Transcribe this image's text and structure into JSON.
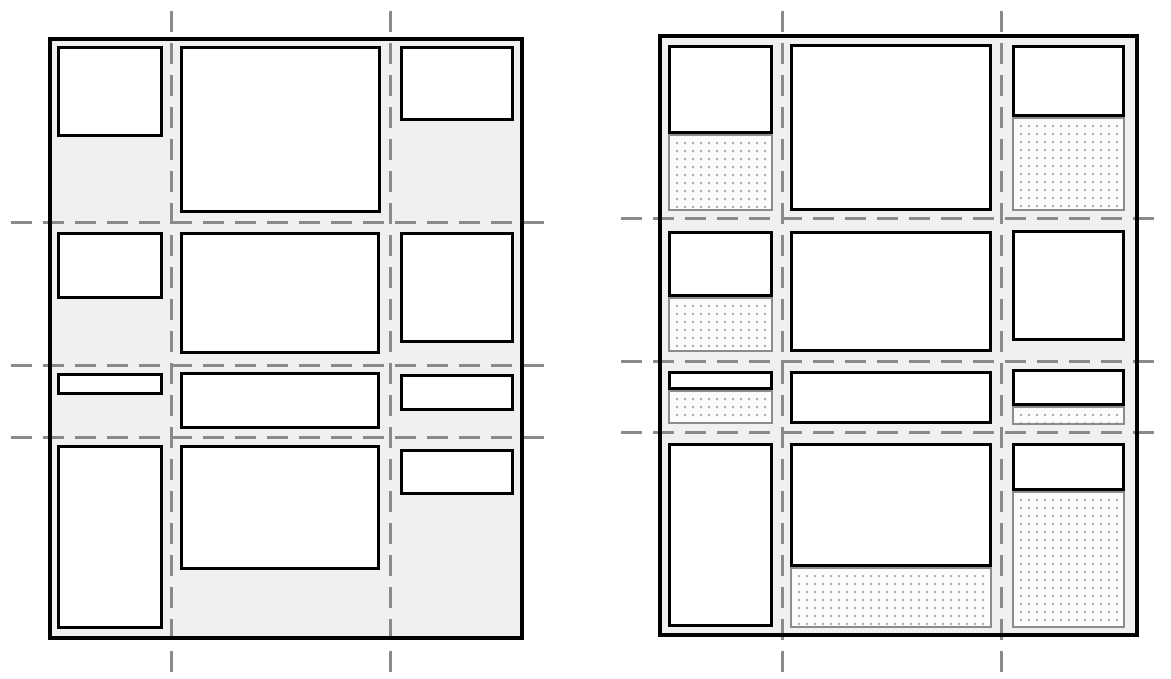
{
  "canvas": {
    "width": 1171,
    "height": 679,
    "background": "#ffffff"
  },
  "style": {
    "container_background": "#f0f0f0",
    "container_border_color": "#000000",
    "container_border_width": 4,
    "item_background": "#ffffff",
    "item_border_color": "#000000",
    "item_border_width": 3,
    "filler_background": "#fcfcfc",
    "filler_border_color": "#8c8c8c",
    "filler_border_width": 2,
    "filler_dot_color": "#b0b0b0",
    "filler_dot_spacing": 8,
    "gridline_color": "#8a8a8a",
    "gridline_thickness": 3,
    "gridline_dash": 21,
    "gridline_gap": 11
  },
  "panels": [
    {
      "id": "left-grid-diagram",
      "container": {
        "x": 48,
        "y": 37,
        "w": 476,
        "h": 603
      },
      "gridlines": {
        "vertical": [
          {
            "x": 170,
            "y1": 11,
            "y2": 672
          },
          {
            "x": 389,
            "y1": 11,
            "y2": 672
          }
        ],
        "horizontal": [
          {
            "y": 221,
            "x1": 11,
            "x2": 547
          },
          {
            "y": 364,
            "x1": 11,
            "x2": 547
          },
          {
            "y": 436,
            "x1": 11,
            "x2": 547
          }
        ]
      },
      "items": [
        [
          57,
          46,
          106,
          91
        ],
        [
          180,
          46,
          201,
          167
        ],
        [
          400,
          46,
          114,
          75
        ],
        [
          57,
          232,
          106,
          67
        ],
        [
          180,
          232,
          200,
          122
        ],
        [
          400,
          232,
          114,
          111
        ],
        [
          57,
          373,
          106,
          22
        ],
        [
          180,
          372,
          200,
          57
        ],
        [
          400,
          374,
          114,
          37
        ],
        [
          57,
          445,
          106,
          184
        ],
        [
          180,
          445,
          200,
          125
        ],
        [
          400,
          449,
          114,
          46
        ]
      ],
      "fillers": []
    },
    {
      "id": "right-grid-diagram",
      "container": {
        "x": 658,
        "y": 34,
        "w": 481,
        "h": 603
      },
      "gridlines": {
        "vertical": [
          {
            "x": 781,
            "y1": 11,
            "y2": 672
          },
          {
            "x": 1000,
            "y1": 11,
            "y2": 672
          }
        ],
        "horizontal": [
          {
            "y": 217,
            "x1": 621,
            "x2": 1157
          },
          {
            "y": 360,
            "x1": 621,
            "x2": 1157
          },
          {
            "y": 431,
            "x1": 621,
            "x2": 1157
          }
        ]
      },
      "items": [
        [
          668,
          45,
          105,
          89
        ],
        [
          790,
          44,
          202,
          167
        ],
        [
          1012,
          45,
          113,
          72
        ],
        [
          668,
          231,
          105,
          66
        ],
        [
          790,
          231,
          202,
          121
        ],
        [
          1012,
          230,
          113,
          111
        ],
        [
          668,
          371,
          105,
          19
        ],
        [
          790,
          371,
          202,
          53
        ],
        [
          1012,
          369,
          113,
          37
        ],
        [
          668,
          443,
          105,
          184
        ],
        [
          790,
          443,
          202,
          124
        ],
        [
          1012,
          443,
          113,
          48
        ]
      ],
      "fillers": [
        [
          668,
          134,
          105,
          77
        ],
        [
          1012,
          117,
          113,
          94
        ],
        [
          668,
          297,
          105,
          55
        ],
        [
          668,
          390,
          105,
          34
        ],
        [
          1012,
          406,
          113,
          19
        ],
        [
          790,
          567,
          202,
          61
        ],
        [
          1012,
          491,
          113,
          137
        ]
      ]
    }
  ]
}
